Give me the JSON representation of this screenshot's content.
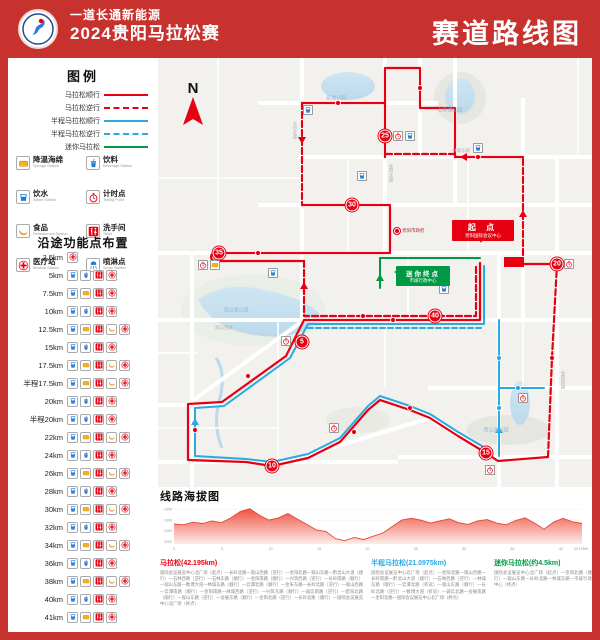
{
  "colors": {
    "poster_red": "#c8322e",
    "route_red": "#e60012",
    "route_blue": "#29abe2",
    "route_green": "#009944"
  },
  "header": {
    "sponsor_line": "一道长通新能源",
    "event_line": "2024贵阳马拉松赛",
    "right_title": "赛道路线图"
  },
  "legend": {
    "title": "图例",
    "routes": [
      {
        "label": "马拉松顺行",
        "color": "#e60012",
        "dash": false
      },
      {
        "label": "马拉松逆行",
        "color": "#e60012",
        "dash": true
      },
      {
        "label": "半程马拉松顺行",
        "color": "#29abe2",
        "dash": false
      },
      {
        "label": "半程马拉松逆行",
        "color": "#29abe2",
        "dash": true
      },
      {
        "label": "迷你马拉松",
        "color": "#009944",
        "dash": false
      }
    ],
    "facilities": [
      {
        "type": "sponge",
        "zh": "降温海绵",
        "en": "Sponge Station"
      },
      {
        "type": "beverage",
        "zh": "饮料",
        "en": "Beverage Station"
      },
      {
        "type": "water",
        "zh": "饮水",
        "en": "Water Station"
      },
      {
        "type": "timing",
        "zh": "计时点",
        "en": "Timing Point"
      },
      {
        "type": "food",
        "zh": "食品",
        "en": "Refreshment Station"
      },
      {
        "type": "toilet",
        "zh": "洗手间",
        "en": "Toilet"
      },
      {
        "type": "medical",
        "zh": "医疗站",
        "en": "Medical Station"
      },
      {
        "type": "spray",
        "zh": "喷淋点",
        "en": "Spray Station"
      }
    ]
  },
  "waypoints": {
    "title": "沿途功能点布置",
    "rows": [
      {
        "km": "2.5km",
        "icons": [
          "medical"
        ]
      },
      {
        "km": "5km",
        "icons": [
          "water",
          "beverage",
          "toilet",
          "medical"
        ]
      },
      {
        "km": "7.5km",
        "icons": [
          "water",
          "sponge",
          "toilet",
          "medical"
        ]
      },
      {
        "km": "10km",
        "icons": [
          "water",
          "beverage",
          "toilet",
          "medical"
        ]
      },
      {
        "km": "12.5km",
        "icons": [
          "water",
          "sponge",
          "toilet",
          "food",
          "medical"
        ]
      },
      {
        "km": "15km",
        "icons": [
          "water",
          "beverage",
          "toilet",
          "medical"
        ]
      },
      {
        "km": "17.5km",
        "icons": [
          "water",
          "sponge",
          "toilet",
          "food",
          "medical"
        ]
      },
      {
        "km": "半程17.5km",
        "icons": [
          "water",
          "sponge",
          "toilet",
          "food",
          "medical"
        ]
      },
      {
        "km": "20km",
        "icons": [
          "water",
          "beverage",
          "toilet",
          "medical"
        ]
      },
      {
        "km": "半程20km",
        "icons": [
          "water",
          "beverage",
          "toilet",
          "medical"
        ]
      },
      {
        "km": "22km",
        "icons": [
          "water",
          "sponge",
          "toilet",
          "food",
          "medical"
        ]
      },
      {
        "km": "24km",
        "icons": [
          "water",
          "beverage",
          "toilet",
          "medical"
        ]
      },
      {
        "km": "26km",
        "icons": [
          "water",
          "sponge",
          "toilet",
          "food",
          "medical"
        ]
      },
      {
        "km": "28km",
        "icons": [
          "water",
          "beverage",
          "toilet",
          "medical"
        ]
      },
      {
        "km": "30km",
        "icons": [
          "water",
          "sponge",
          "toilet",
          "food",
          "medical"
        ]
      },
      {
        "km": "32km",
        "icons": [
          "water",
          "beverage",
          "toilet",
          "medical"
        ]
      },
      {
        "km": "34km",
        "icons": [
          "water",
          "sponge",
          "toilet",
          "food",
          "medical"
        ]
      },
      {
        "km": "36km",
        "icons": [
          "water",
          "beverage",
          "toilet",
          "medical"
        ]
      },
      {
        "km": "38km",
        "icons": [
          "water",
          "sponge",
          "toilet",
          "food",
          "medical"
        ]
      },
      {
        "km": "40km",
        "icons": [
          "water",
          "beverage",
          "toilet",
          "medical"
        ]
      },
      {
        "km": "41km",
        "icons": [
          "water",
          "sponge",
          "toilet",
          "medical"
        ]
      }
    ]
  },
  "map": {
    "compass": "N",
    "start_label": {
      "line1": "起 点",
      "line2": "贵阳国际会议中心"
    },
    "mini_finish_label": {
      "line1": "迷你终点",
      "line2": "市级行政中心"
    },
    "poi_label": "贵阳市政府",
    "km_markers": [
      {
        "n": "5",
        "x": 144,
        "y": 284
      },
      {
        "n": "10",
        "x": 114,
        "y": 408
      },
      {
        "n": "15",
        "x": 328,
        "y": 395
      },
      {
        "n": "20",
        "x": 399,
        "y": 206
      },
      {
        "n": "25",
        "x": 227,
        "y": 78
      },
      {
        "n": "30",
        "x": 194,
        "y": 147
      },
      {
        "n": "35",
        "x": 61,
        "y": 195
      },
      {
        "n": "40",
        "x": 277,
        "y": 258
      }
    ],
    "facility_points": [
      {
        "type": "timing",
        "x": 45,
        "y": 207
      },
      {
        "type": "sponge",
        "x": 57,
        "y": 207
      },
      {
        "type": "timing",
        "x": 128,
        "y": 283
      },
      {
        "type": "timing",
        "x": 176,
        "y": 370
      },
      {
        "type": "water",
        "x": 320,
        "y": 90
      },
      {
        "type": "timing",
        "x": 240,
        "y": 78
      },
      {
        "type": "water",
        "x": 252,
        "y": 78
      },
      {
        "type": "timing",
        "x": 411,
        "y": 206
      },
      {
        "type": "timing",
        "x": 332,
        "y": 412
      },
      {
        "type": "water",
        "x": 286,
        "y": 231
      },
      {
        "type": "water",
        "x": 150,
        "y": 52
      },
      {
        "type": "water",
        "x": 204,
        "y": 118
      },
      {
        "type": "water",
        "x": 115,
        "y": 215
      },
      {
        "type": "timing",
        "x": 365,
        "y": 340
      }
    ],
    "lake_labels": [
      {
        "text": "泉湖公园",
        "x": 178,
        "y": 40
      },
      {
        "text": "七彩湖公园",
        "x": 292,
        "y": 52
      },
      {
        "text": "观山湖公园",
        "x": 78,
        "y": 252
      },
      {
        "text": "阅山湖公园",
        "x": 338,
        "y": 372
      }
    ],
    "road_labels": [
      {
        "text": "金阳北路",
        "x": 233,
        "y": 115,
        "v": true
      },
      {
        "text": "长岭北路",
        "x": 137,
        "y": 72,
        "v": true
      },
      {
        "text": "观山西路",
        "x": 66,
        "y": 270
      },
      {
        "text": "林城东路",
        "x": 303,
        "y": 93
      },
      {
        "text": "金阳南路",
        "x": 405,
        "y": 322,
        "v": true
      }
    ]
  },
  "elevation": {
    "title": "线路海拔图"
  },
  "chart_data": {
    "type": "area",
    "title": "线路海拔图",
    "xlabel": "距离(km)",
    "ylabel": "海拔(m)",
    "x_ticks": [
      "0",
      "5",
      "10",
      "15",
      "20",
      "25",
      "30",
      "35",
      "40",
      "42.195KM"
    ],
    "y_ticks": [
      1350,
      1300,
      1250,
      1200
    ],
    "xlim": [
      0,
      42.195
    ],
    "ylim": [
      1190,
      1360
    ],
    "values": [
      1282,
      1278,
      1290,
      1284,
      1296,
      1288,
      1310,
      1340,
      1352,
      1322,
      1300,
      1310,
      1330,
      1305,
      1280,
      1255,
      1248,
      1215,
      1205,
      1220,
      1210,
      1226,
      1240,
      1270,
      1300,
      1308,
      1300,
      1286,
      1296,
      1306,
      1288,
      1280,
      1296,
      1302,
      1286,
      1278,
      1298,
      1310,
      1286,
      1258,
      1290,
      1308,
      1292,
      1284
    ]
  },
  "descriptions": [
    {
      "title": "马拉松(42.195km)",
      "color": "#e60012",
      "body": "国际会议展览中心北广场（起点）—长岭北路—观山西路（逆行）—金阳北路—观山东路—黔灵山大道（顺行）—石林西路（逆行）—石林东路（顺行）—金阳南路（顺行）—兴筑西路（逆行）—长岭南路（顺行）—观山东路—数博大道—林城东路（顺行）—云潭北路（顺行）—金朱东路—长岭北路（逆行）—观山西路—云潭南路（顺行）—金阳南路—林城西路（逆行）—兴筑东路（顺行）—诚信南路（逆行）—碧海北路（顺行）—观山东路（逆行）—会展东路（顺行）—金阳北路（逆行）—长岭北路（顺行）—国际会议展览中心北广场（终点）"
    },
    {
      "title": "半程马拉松(21.0975km)",
      "color": "#29abe2",
      "body": "国际会议展览中心北广场（起点）—金阳北路—观山西路—长岭南路—黔灵山大道（顺行）—石林西路（逆行）—林城东路（顺行）—云潭北路（折返）—观山东路（顺行）—长岭北路（逆行）—数博大道（折返）—诚信北路—会展南路—金阳北路—国际会议展览中心北广场（终点）"
    },
    {
      "title": "迷你马拉松(约4.5km)",
      "color": "#009944",
      "body": "国际会议展览中心北广场（起点）—金阳北路（顺行）—观山东路—长岭北路—林城东路—市级行政中心（终点）"
    }
  ]
}
